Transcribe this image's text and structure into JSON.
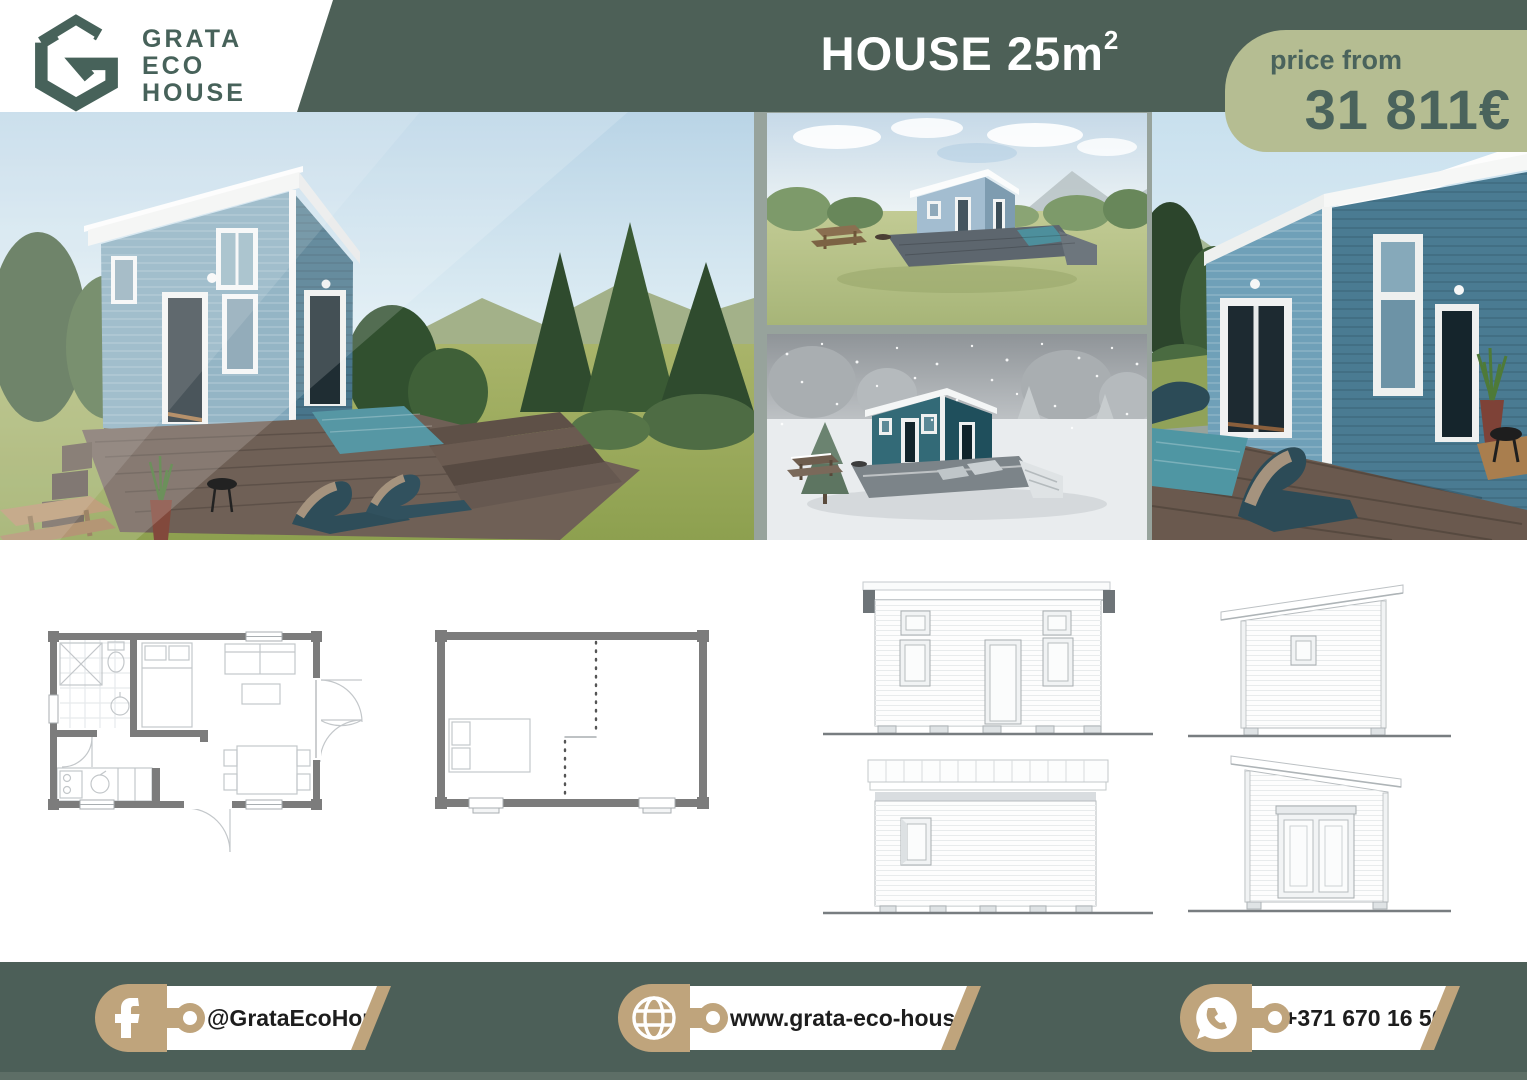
{
  "logo": {
    "mark": "hexagon-g-logo",
    "line1": "GRATA",
    "line2": "ECO",
    "line3": "HOUSE"
  },
  "header": {
    "title": "HOUSE 25m",
    "title_superscript": "2"
  },
  "price_badge": {
    "label": "price from",
    "value": "31 811€"
  },
  "gallery": {
    "main_photo": "exterior-render-summer",
    "top_photo": "exterior-render-watercolor",
    "bottom_photo": "exterior-render-winter",
    "right_photo": "exterior-render-terrace-closeup"
  },
  "drawings": {
    "plan_furnished": "floor-plan-furnished",
    "plan_empty": "floor-plan-empty",
    "elevation_front": "elevation-front",
    "elevation_side_a": "elevation-side-window",
    "elevation_rear": "elevation-rear",
    "elevation_side_b": "elevation-side-doors"
  },
  "footer": {
    "contacts": [
      {
        "icon": "facebook-icon",
        "value": "@GrataEcoHouse"
      },
      {
        "icon": "globe-icon",
        "value": "www.grata-eco-house.com"
      },
      {
        "icon": "whatsapp-icon",
        "value": "+371 670 16 500"
      }
    ]
  },
  "colors": {
    "header_green": "#4d6057",
    "footer_green": "#4c5f58",
    "badge_sage": "#b5bd92",
    "badge_text": "#4a635c",
    "gold": "#bfa47c",
    "logo_teal": "#47625a",
    "photo_gap": "#97a39c"
  }
}
